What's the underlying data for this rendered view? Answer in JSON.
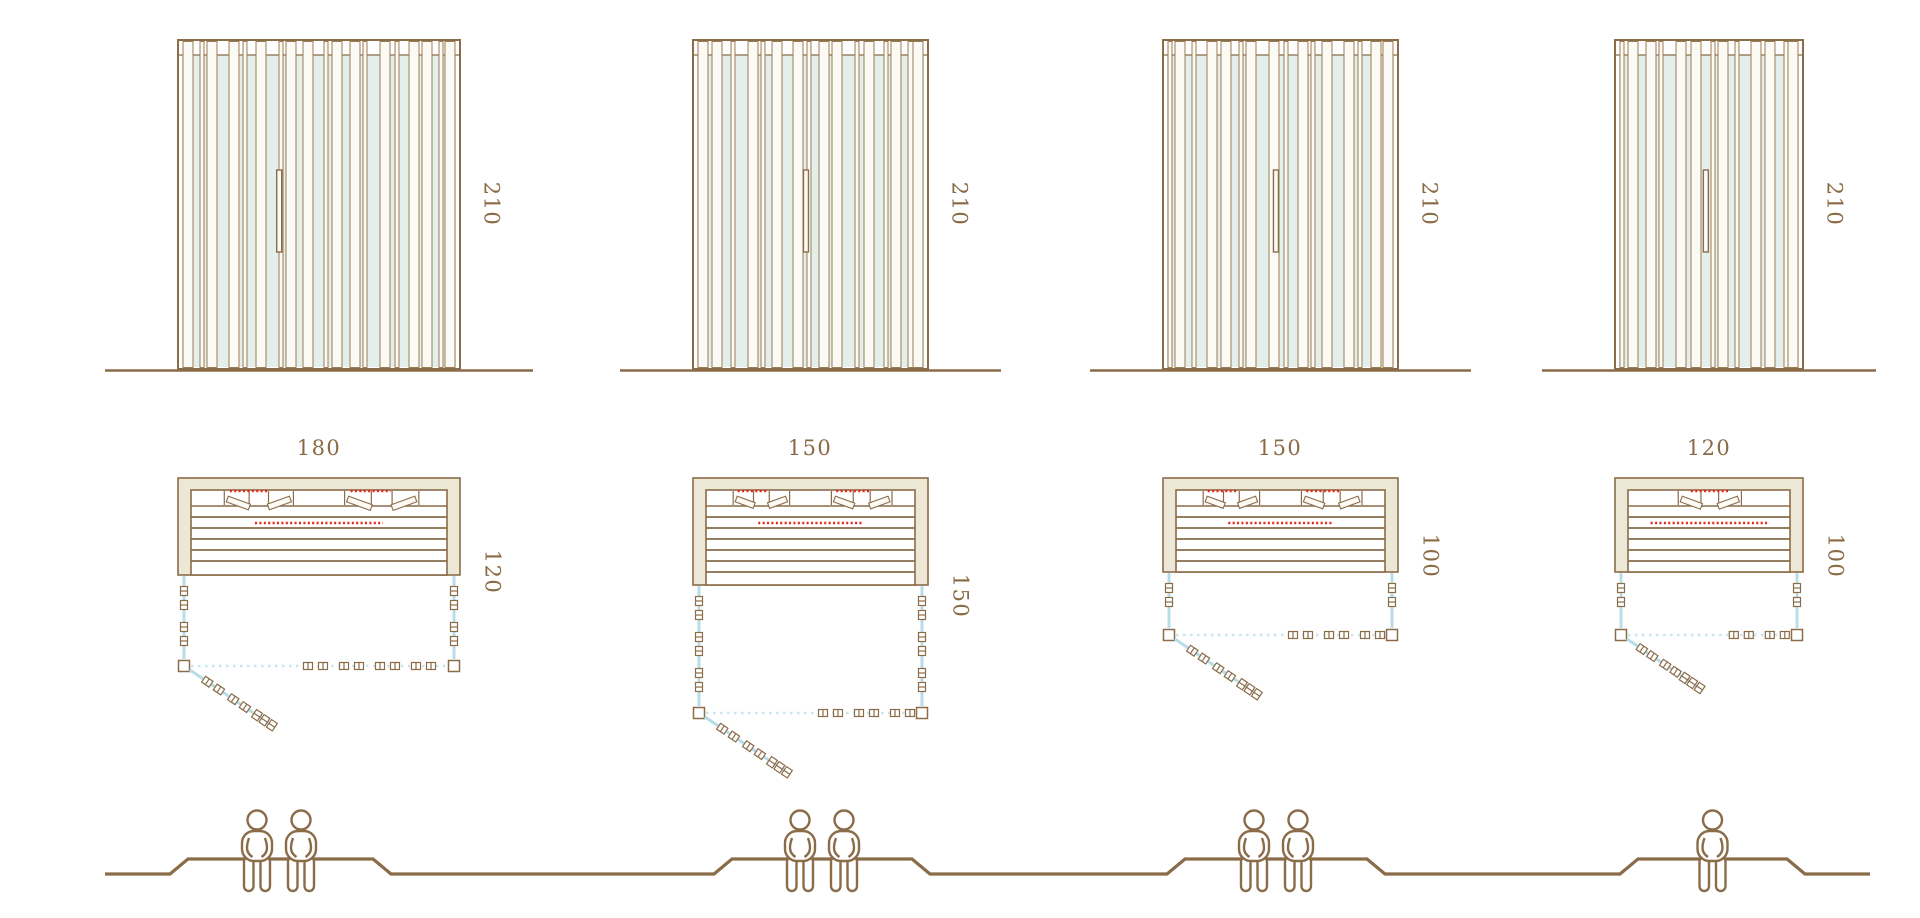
{
  "diagram_title": "sauna-cabin-size-comparison",
  "palette": {
    "line": "#8a6c49",
    "slat_line": "#9c7c54",
    "slat_fill": "#fcfaf5",
    "wall_fill": "#ece8d5",
    "glass_fill": "#e4efeb",
    "glass_line": "#b7dee8",
    "glass_dots": "#c9e6ee",
    "heater_red": "#e62417",
    "figure_line": "#8a6c49",
    "label": "#8a6a45",
    "background": "#ffffff"
  },
  "cabins": [
    {
      "id": "cabin-1",
      "height_label": "210",
      "width_label": "180",
      "depth_label": "120",
      "capacity": 2
    },
    {
      "id": "cabin-2",
      "height_label": "210",
      "width_label": "150",
      "depth_label": "150",
      "capacity": 2
    },
    {
      "id": "cabin-3",
      "height_label": "210",
      "width_label": "150",
      "depth_label": "100",
      "capacity": 2
    },
    {
      "id": "cabin-4",
      "height_label": "210",
      "width_label": "120",
      "depth_label": "100",
      "capacity": 1
    }
  ]
}
